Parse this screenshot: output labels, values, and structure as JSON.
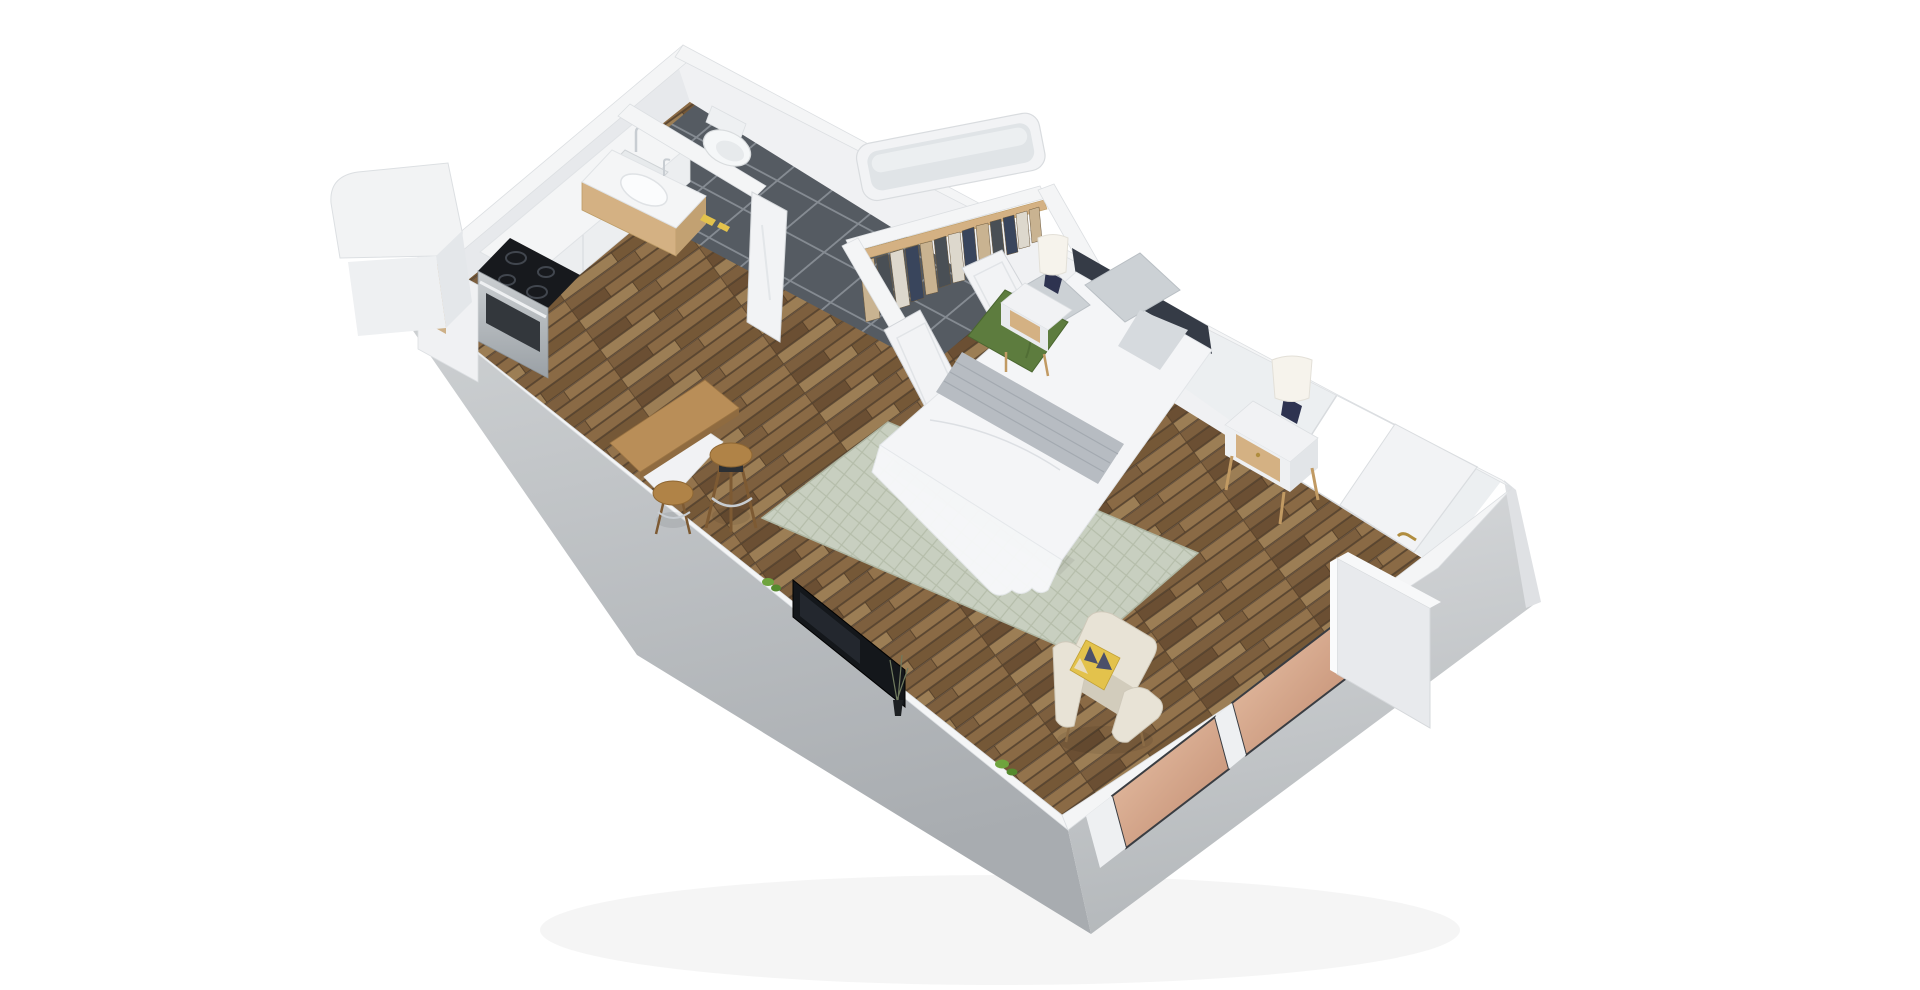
{
  "scene": {
    "type": "3d-floor-plan-render",
    "description": "Isometric 3D floor plan of a studio apartment on white background",
    "rooms": [
      "kitchen",
      "bathroom",
      "closet",
      "bedroom-living-area"
    ],
    "items": [
      "tall-cabinet",
      "fridge",
      "stove",
      "oven-door",
      "kitchen-counter",
      "kitchen-sink",
      "bathroom-vanity",
      "toilet",
      "bathtub",
      "bathroom-door",
      "bath-mat",
      "closet-rail",
      "closet-clothes",
      "closet-door-left",
      "closet-door-right",
      "bed",
      "bed-headboard",
      "pillow-green",
      "bed-throw-blanket",
      "nightstand-left",
      "nightstand-right",
      "table-lamp-left",
      "table-lamp-right",
      "area-rug",
      "armchair",
      "accent-pillow",
      "tv-screen",
      "plant-vase-twigs",
      "bar-table",
      "bar-stool-left",
      "bar-stool-right",
      "window-pane-1",
      "window-pane-2",
      "entry-door",
      "door-handle"
    ]
  },
  "colors": {
    "background": "#ffffff",
    "wall_top": "#f4f5f6",
    "wall_interior": "#f0f1f3",
    "wall_interior_shaded": "#e7e9ec",
    "wall_edge": "#d8dbde",
    "skirt_left_top": "#cfd2d4",
    "skirt_left_bottom": "#a8acb0",
    "skirt_right_top": "#d8dadc",
    "skirt_right_bottom": "#b4b8bb",
    "wood_1": "#7d5f3e",
    "wood_2": "#93734c",
    "wood_3": "#6b4f33",
    "wood_4": "#8a6a45",
    "wood_5": "#9c7e55",
    "wood_6": "#755837",
    "wood_seam": "#4a3622",
    "tile_base": "#555b62",
    "tile_grout": "#858b92",
    "rug_base": "#c8cfc0",
    "rug_line": "#b5bdaa",
    "headboard": "#353b46",
    "bedding_white": "#f4f5f7",
    "bedding_shadow": "#dcdfe3",
    "throw_gray": "#b7bcc2",
    "pillow_gray": "#ccd1d5",
    "pillow_green": "#5d7c3e",
    "pillow_green_dark": "#4a6630",
    "nightstand_white": "#f1f2f4",
    "furniture_oak": "#d4b183",
    "furniture_oak_dark": "#c19a63",
    "lamp_shade": "#f6f3ec",
    "lamp_body_navy": "#2e3350",
    "lamp_gold": "#c9a54e",
    "armchair_cream": "#e8e3d6",
    "armchair_shadow": "#d2ccbc",
    "accent_yellow": "#e3c24c",
    "accent_navy": "#4c5069",
    "tv_black": "#14171b",
    "tv_glare": "#2a2f36",
    "table_wood": "#b98e58",
    "table_wood_side": "#8f6b40",
    "stool_seat": "#b08347",
    "chrome": "#c8cdd2",
    "steel_light": "#ccd0d3",
    "steel_dark": "#9aa0a5",
    "oven_window": "#33373c",
    "cooktop": "#17191d",
    "burner_ring": "#41464e",
    "glass_copper_light": "#e9c3a8",
    "glass_copper": "#c08a6f",
    "glass_frame_dark": "#3a3d42",
    "door_white": "#f2f3f5",
    "handle_gold": "#b08d3f",
    "plant_green": "#6fa43e",
    "plant_green_dark": "#558a2e",
    "clothes_tan": "#c9b391",
    "clothes_navy": "#39455c",
    "clothes_charcoal": "#494f55",
    "clothes_cream": "#ddd8cd",
    "basin_white": "#fbfcfd",
    "shadow": "#000000"
  }
}
